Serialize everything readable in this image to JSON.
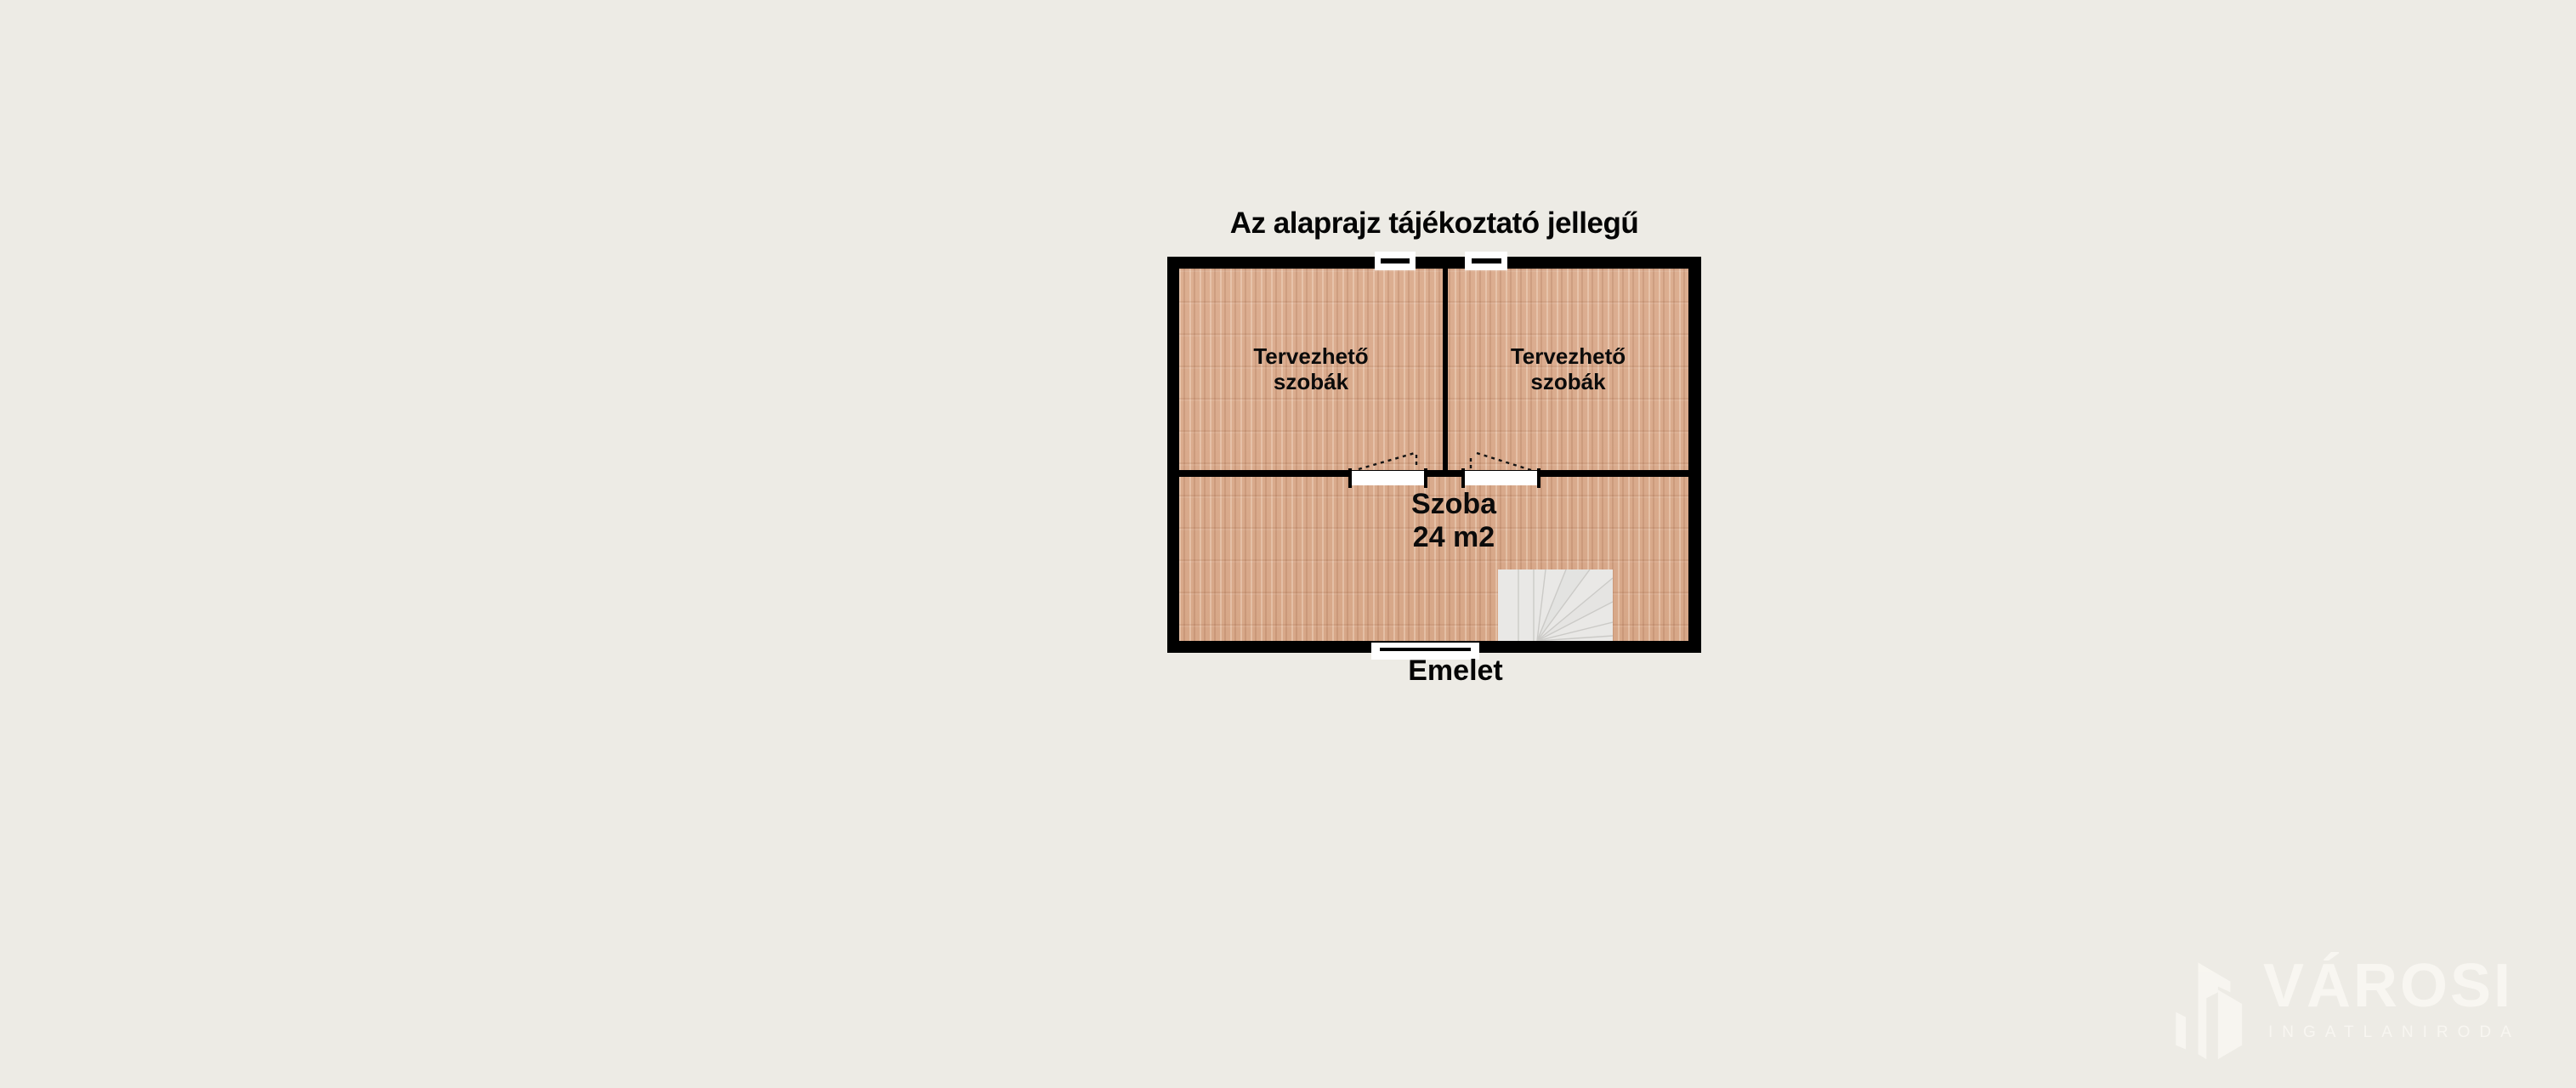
{
  "title": "Az alaprajz tájékoztató jellegű",
  "floor_label": "Emelet",
  "rooms": [
    {
      "id": "top-left",
      "line1": "Tervezhető",
      "line2": "szobák"
    },
    {
      "id": "top-right",
      "line1": "Tervezhető",
      "line2": "szobák"
    },
    {
      "id": "bottom",
      "line1": "Szoba",
      "line2": "24 m2"
    }
  ],
  "features": {
    "windows": [
      "top-left-window",
      "top-right-window",
      "bottom-window"
    ],
    "doors": [
      "left-swing-door",
      "right-swing-door"
    ],
    "stairs": "winder-staircase-icon"
  },
  "watermark": {
    "brand": "VÁROSI",
    "subtitle": "INGATLANIRODA",
    "icon": "city-buildings-icon"
  },
  "colors": {
    "background": "#edebe5",
    "wall": "#000000",
    "floor_wood": "#d9aa8c",
    "stairs": "#e9e8e6",
    "text": "#050505",
    "watermark": "#f8f6f1"
  }
}
